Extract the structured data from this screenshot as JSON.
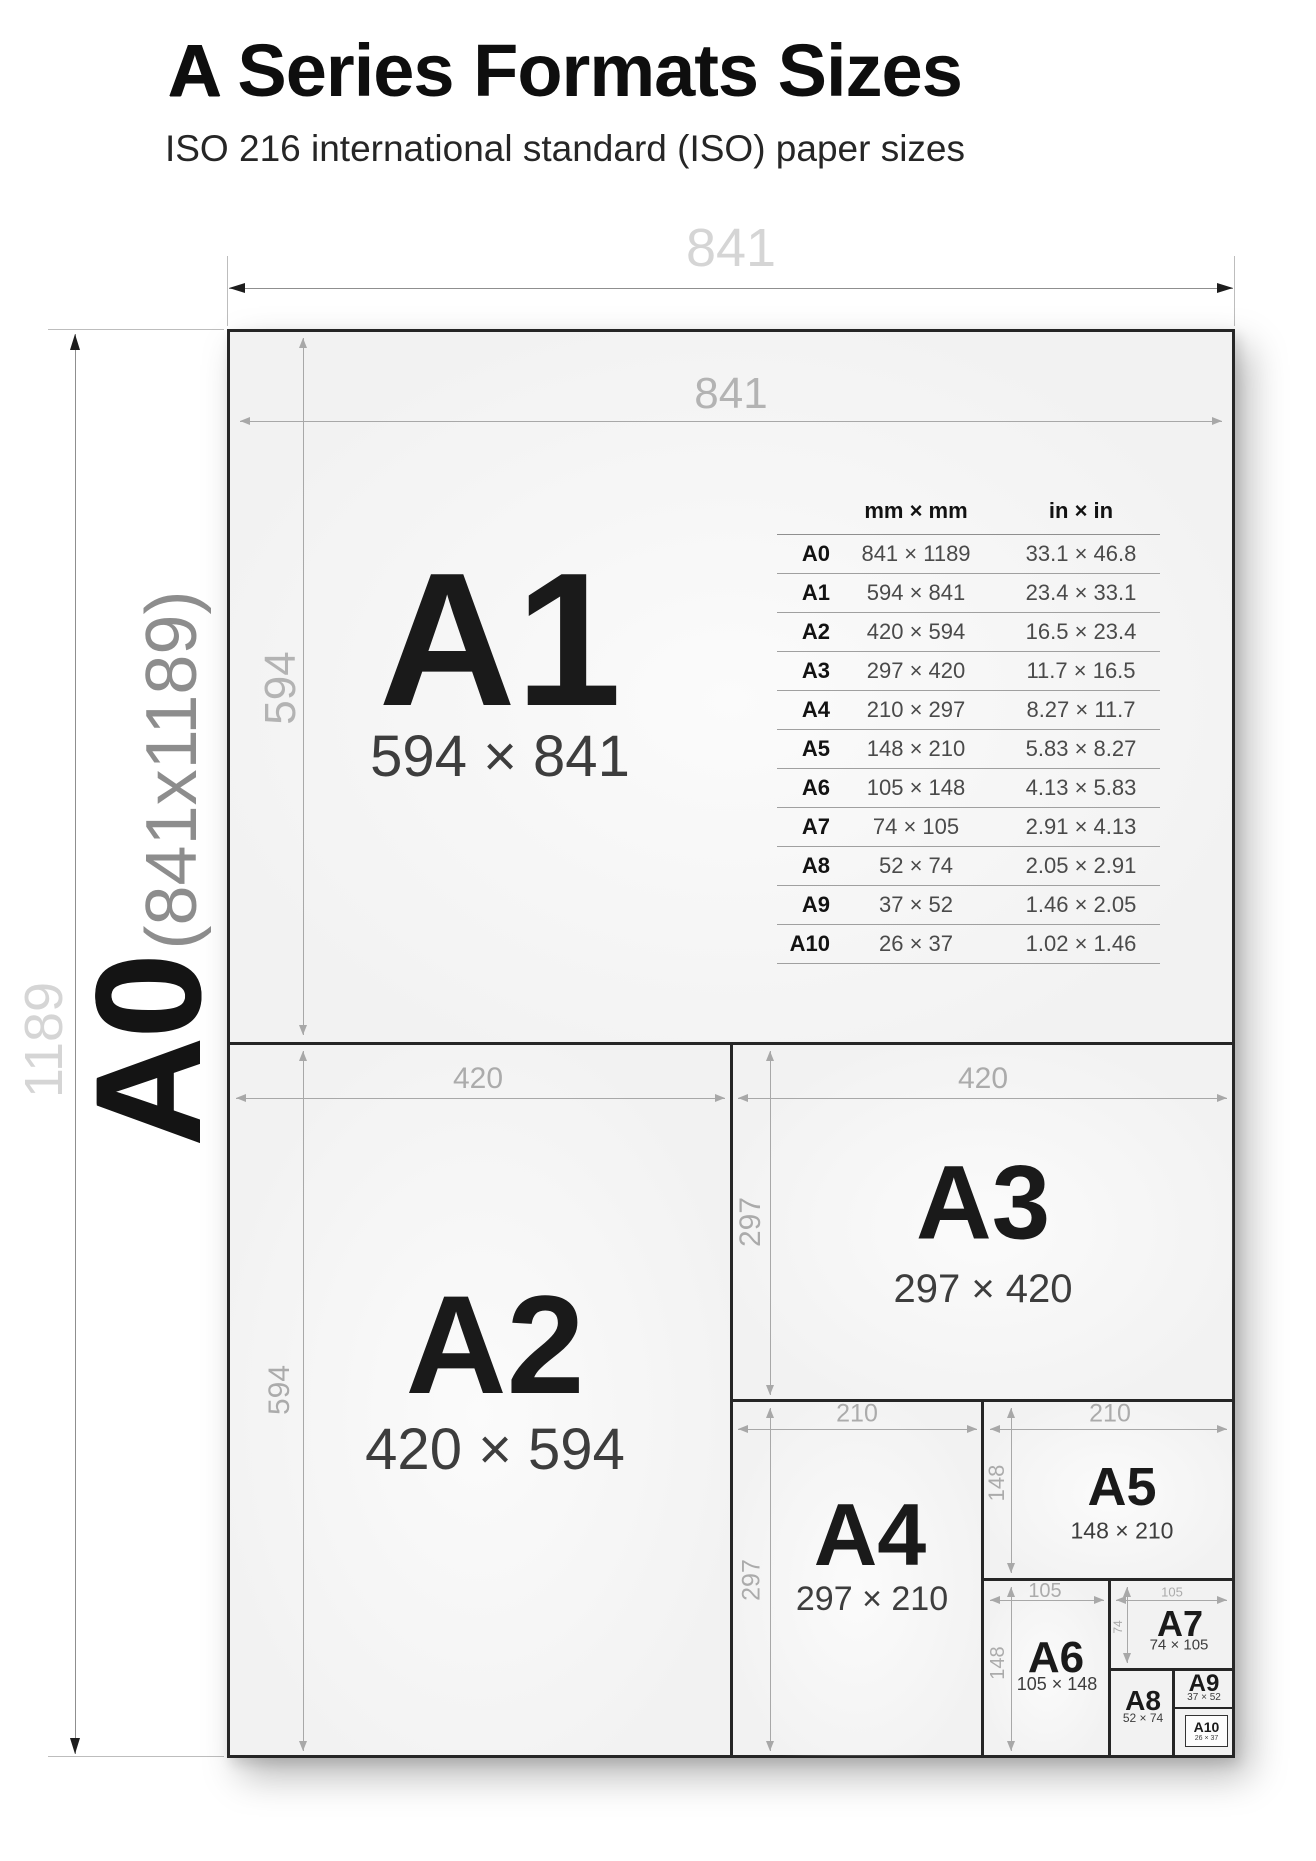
{
  "title": {
    "bold_letter": "A",
    "rest": " Series Formats Sizes"
  },
  "subtitle": "ISO 216 international standard (ISO) paper sizes",
  "side_label": {
    "name": "A0",
    "dims": "(841x1189)"
  },
  "outer_dims": {
    "width": "841",
    "height": "1189"
  },
  "papers": {
    "a1": {
      "name": "A1",
      "size": "594 × 841",
      "width_dim": "841",
      "height_dim": "594"
    },
    "a2": {
      "name": "A2",
      "size": "420 × 594",
      "width_dim": "420",
      "height_dim": "594"
    },
    "a3": {
      "name": "A3",
      "size": "297 × 420",
      "width_dim": "420",
      "height_dim": "297"
    },
    "a4": {
      "name": "A4",
      "size": "297 × 210",
      "width_dim": "210",
      "height_dim": "297"
    },
    "a5": {
      "name": "A5",
      "size": "148 × 210",
      "width_dim": "210",
      "height_dim": "148"
    },
    "a6": {
      "name": "A6",
      "size": "105 × 148",
      "width_dim": "105",
      "height_dim": "148"
    },
    "a7": {
      "name": "A7",
      "size": "74 × 105",
      "width_dim": "105",
      "height_dim": "74"
    },
    "a8": {
      "name": "A8",
      "size": "52 × 74"
    },
    "a9": {
      "name": "A9",
      "size": "37 × 52"
    },
    "a10": {
      "name": "A10",
      "size": "26 × 37"
    }
  },
  "table": {
    "headers": {
      "mm": "mm × mm",
      "in": "in × in"
    },
    "rows": [
      {
        "label": "A0",
        "mm": "841 × 1189",
        "in": "33.1 × 46.8"
      },
      {
        "label": "A1",
        "mm": "594 × 841",
        "in": "23.4 × 33.1"
      },
      {
        "label": "A2",
        "mm": "420 × 594",
        "in": "16.5 × 23.4"
      },
      {
        "label": "A3",
        "mm": "297 × 420",
        "in": "11.7 × 16.5"
      },
      {
        "label": "A4",
        "mm": "210 × 297",
        "in": "8.27 × 11.7"
      },
      {
        "label": "A5",
        "mm": "148 × 210",
        "in": "5.83 × 8.27"
      },
      {
        "label": "A6",
        "mm": "105 × 148",
        "in": "4.13 × 5.83"
      },
      {
        "label": "A7",
        "mm": "74 × 105",
        "in": "2.91 × 4.13"
      },
      {
        "label": "A8",
        "mm": "52 × 74",
        "in": "2.05 × 2.91"
      },
      {
        "label": "A9",
        "mm": "37 × 52",
        "in": "1.46 × 2.05"
      },
      {
        "label": "A10",
        "mm": "26 × 37",
        "in": "1.02 × 1.46"
      }
    ]
  },
  "colors": {
    "sheet_border": "#262626",
    "paper_fill": "#f2f2f2",
    "dim_line": "#a8a8a8",
    "outer_dim_label": "#d5d5d5",
    "inner_dim_label": "#b3b3b3"
  }
}
